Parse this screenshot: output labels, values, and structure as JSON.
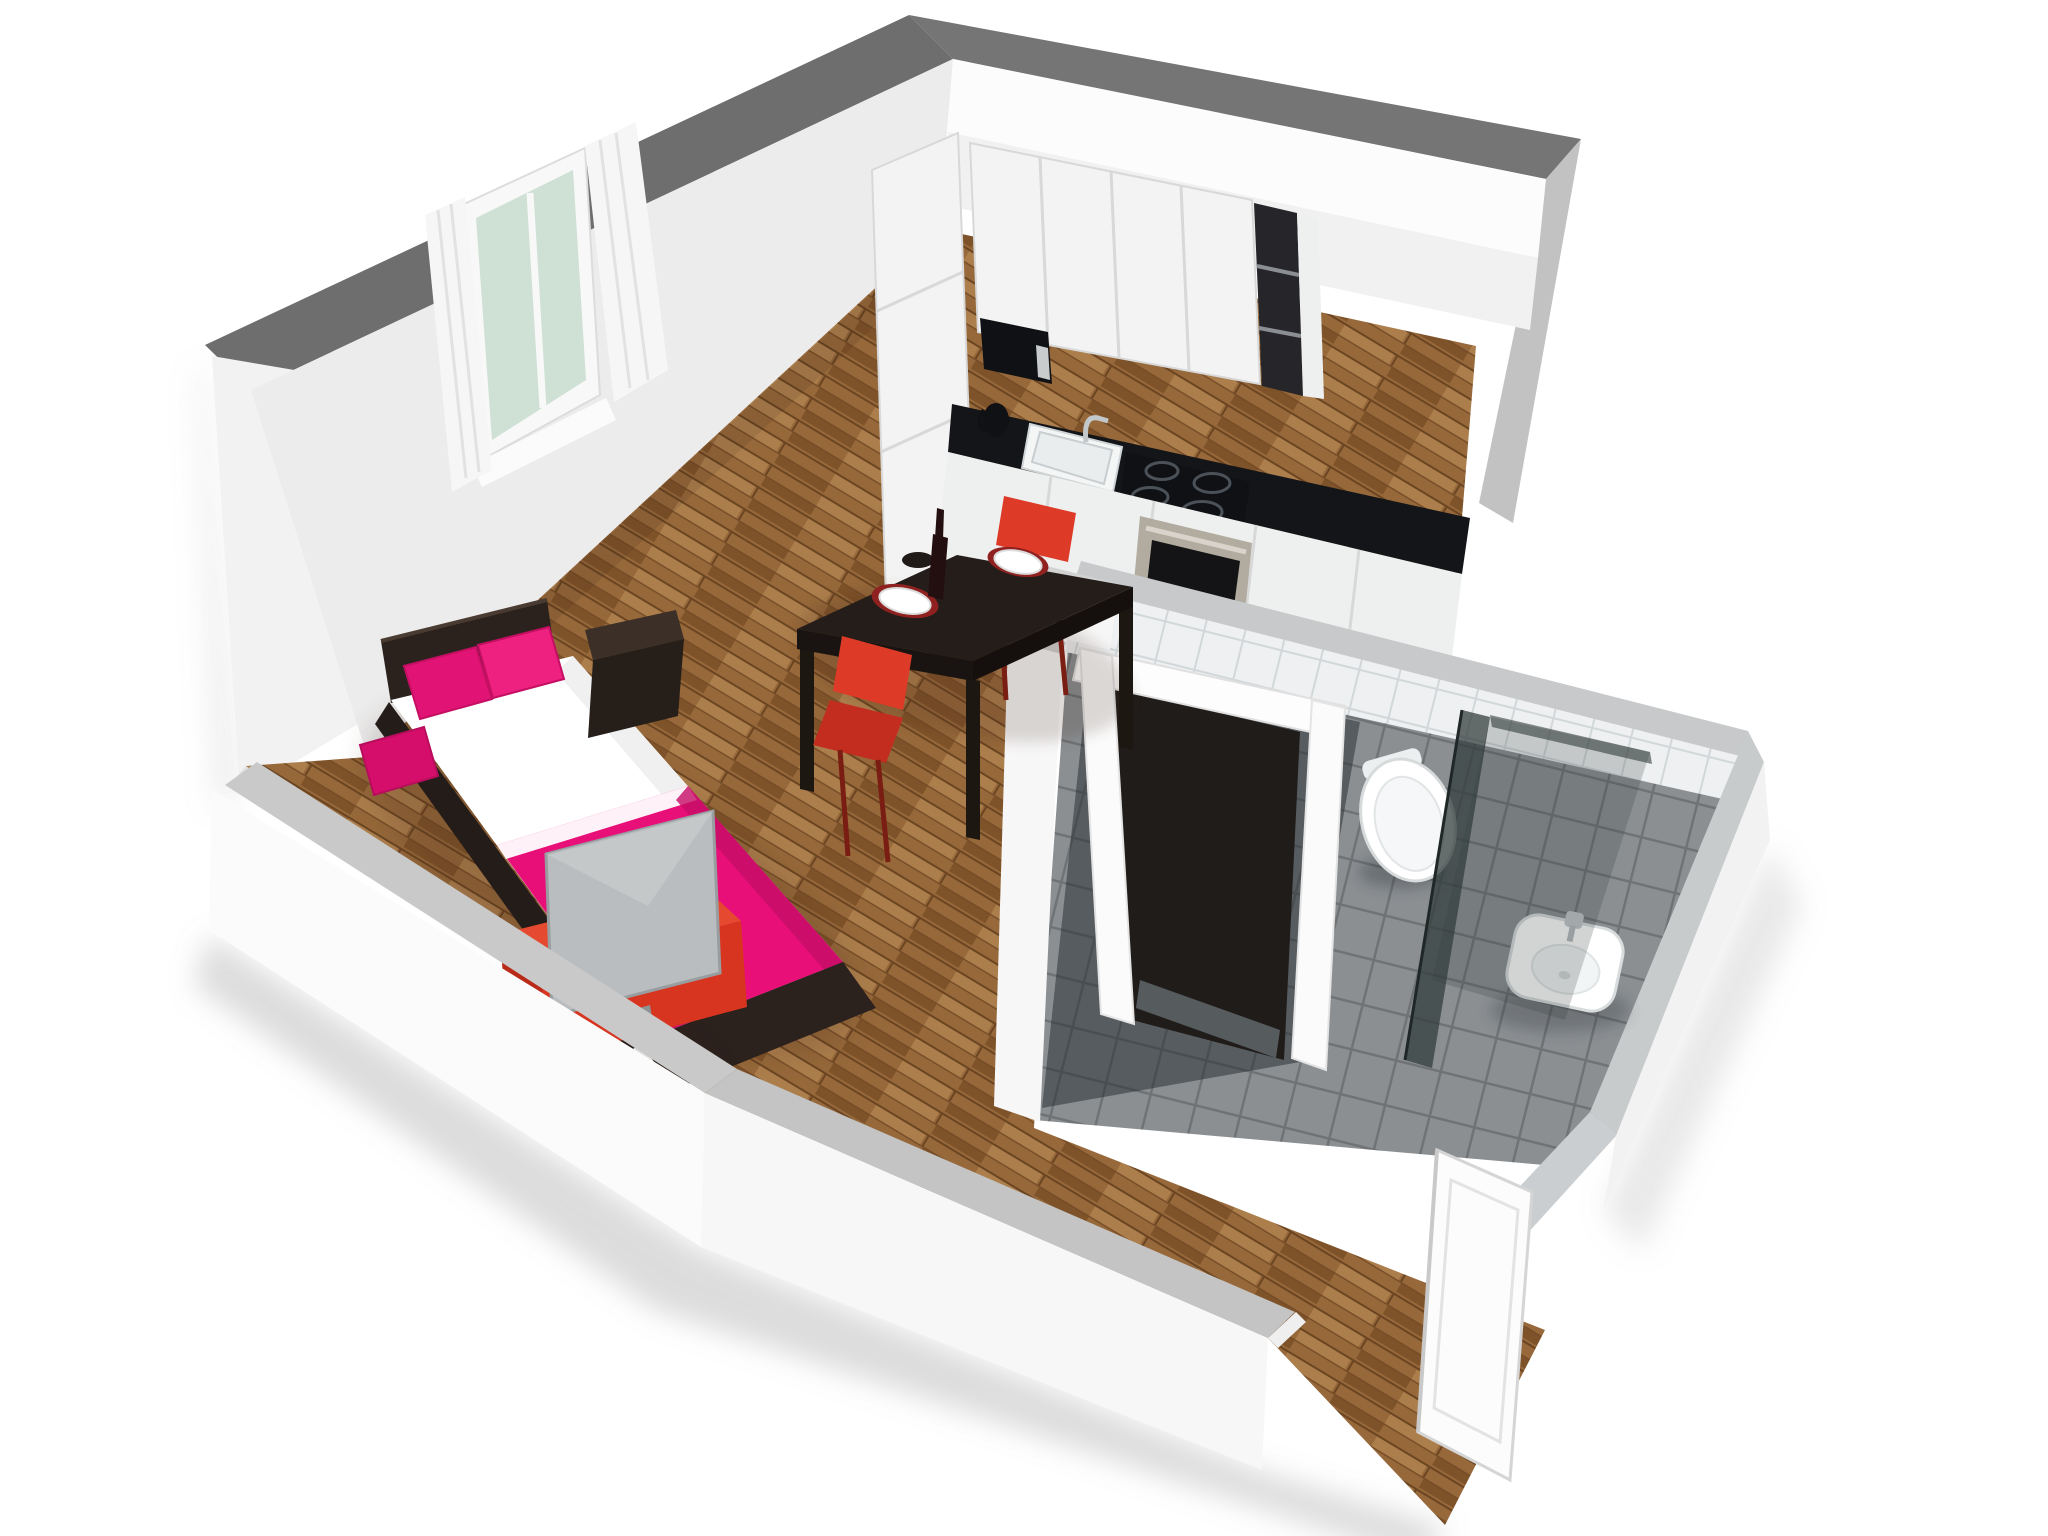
{
  "scene": {
    "type": "3d-floor-plan-rendering",
    "style": "isometric cutaway view on white background",
    "alt": "3D cutaway floor plan rendering of a small studio apartment with a combined living and sleeping room, open kitchen with dining table, bathroom with shower, and entry door"
  },
  "colors": {
    "background": "#ffffff",
    "wall_top_dark": "#6e6e6e",
    "wall_top_light": "#c7c9ca",
    "wall_cut_edge": "#9c9c9c",
    "wall_face": "#ececec",
    "wall_face_bright": "#f7f7f7",
    "soffit_white": "#fcfcfc",
    "wood_mid": "#96683a",
    "wood_light": "#b0824f",
    "wood_dark": "#7c5127",
    "wood_gap": "#6b4522",
    "cabinet_white": "#f3f3f3",
    "cabinet_seam": "#d7d7d7",
    "counter_black": "#141518",
    "appliance_black": "#101114",
    "steel": "#b1aba0",
    "shelf_dark": "#26262a",
    "accent_red": "#dd3b28",
    "accent_red_dark": "#c22d1f",
    "accent_red_deep": "#b92a18",
    "accent_pink": "#e80f78",
    "pink_dark": "#c50c66",
    "pillow_pink": "#e11374",
    "linen_white": "#ffffff",
    "tv_gray": "#b9bdbf",
    "tile_floor": "#8b8f92",
    "tile_grout": "#6f7376",
    "tile_wall": "#eef0f1",
    "tile_wall_grout": "#d2d7d9",
    "glass_dark": "#333d3c",
    "fixture_white": "#ffffff",
    "frame_dark": "#2b221e",
    "table_dark": "#241d19",
    "window_glass": "#cfe0d4",
    "curtain_white": "#f6f6f6",
    "door_white": "#fcfcfc"
  },
  "structure": {
    "walls": {
      "exterior_tall_top": "dark grey cut surface",
      "exterior_low_top": "light grey cut surface",
      "interior_faces": "white"
    },
    "rooms": [
      {
        "id": "living-sleeping-area",
        "floor": "wood parquet",
        "items": [
          "double bed with dark frame",
          "three magenta pillows",
          "white bedding",
          "magenta bedspread",
          "dark nightstand",
          "red tv lowboard",
          "grey flat-screen tv",
          "two-pane window",
          "white curtains"
        ]
      },
      {
        "id": "kitchen-dining",
        "floor": "wood parquet",
        "items": [
          "white tall cabinet",
          "white upper cabinets",
          "built-in microwave",
          "dark open shelf unit",
          "black countertop",
          "inset white sink with chrome faucet",
          "black cooktop with four burners",
          "built-in stainless oven",
          "white base cabinets",
          "black kettle",
          "grey counter return",
          "dark square dining table",
          "two red chairs",
          "wine bottle",
          "two white plates with red mats",
          "dark bowl"
        ]
      },
      {
        "id": "bathroom",
        "floor": "grey tiles",
        "items": [
          "white framed doorway",
          "white tiled walls",
          "wall-hung toilet",
          "white washbasin with chrome faucet",
          "dark glass shower screens"
        ]
      },
      {
        "id": "entry",
        "floor": "wood parquet",
        "items": [
          "open white entry door"
        ]
      }
    ]
  }
}
